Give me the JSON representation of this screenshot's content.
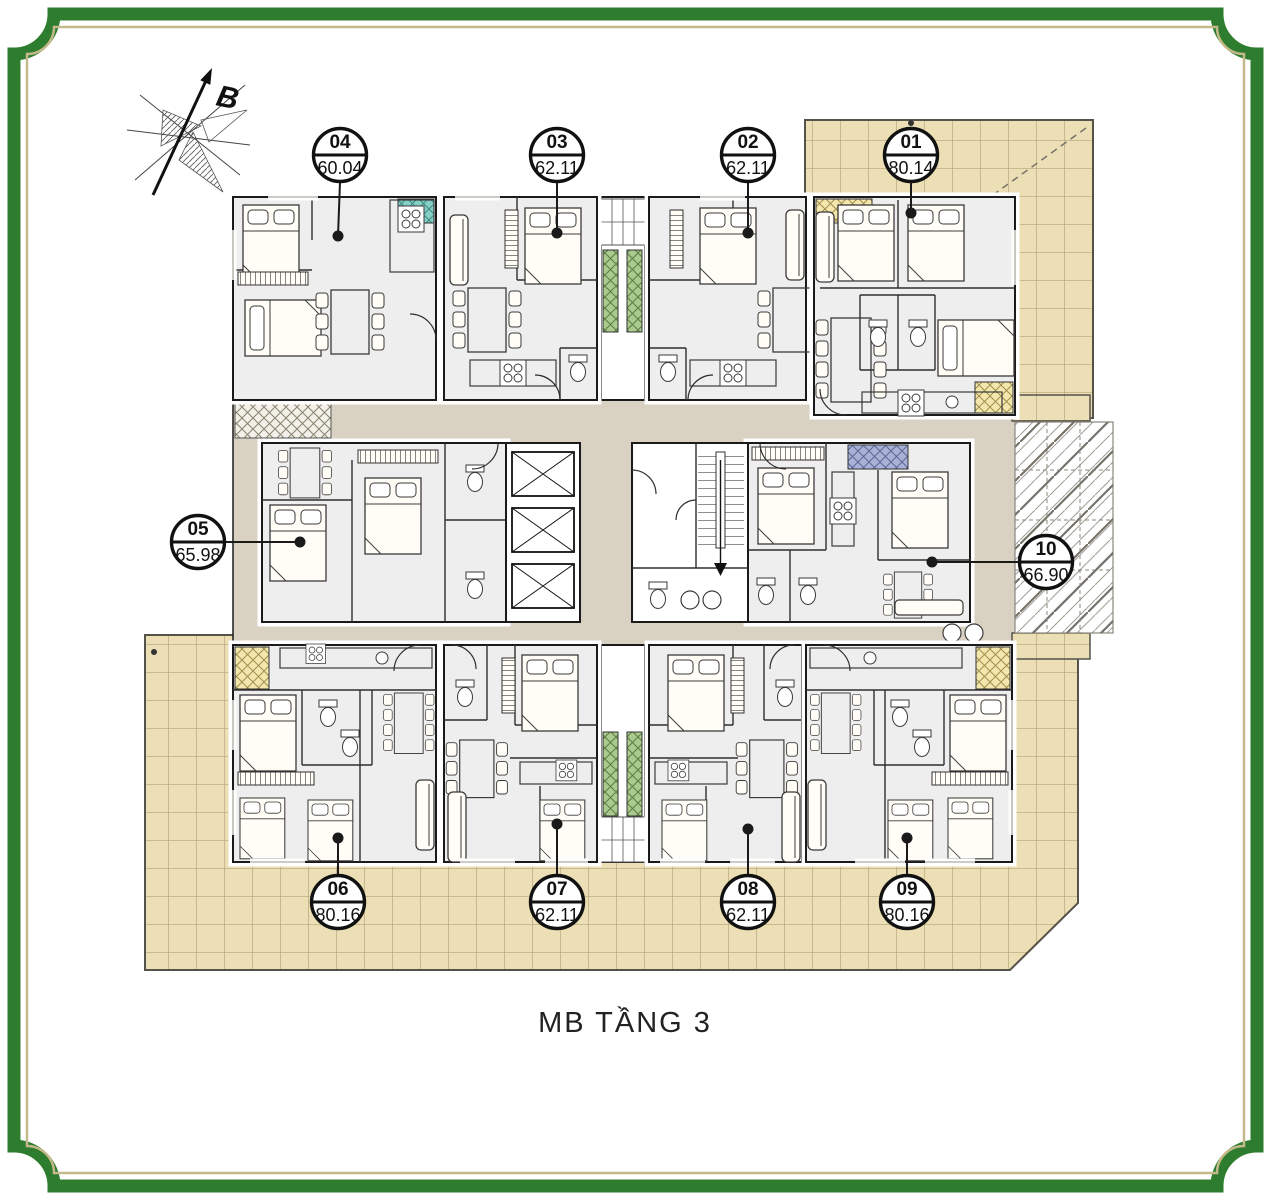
{
  "title": "MB TẦNG 3",
  "compass": {
    "label": "B"
  },
  "units": [
    {
      "id": "01",
      "area": "80.14",
      "color": "#f3e7ae"
    },
    {
      "id": "02",
      "area": "62.11",
      "color": "#a9cb8d"
    },
    {
      "id": "03",
      "area": "62.11",
      "color": "#a9cb8d"
    },
    {
      "id": "04",
      "area": "60.04",
      "color": "#85cfc7"
    },
    {
      "id": "05",
      "area": "65.98",
      "color": "#c7a5cd"
    },
    {
      "id": "06",
      "area": "80.16",
      "color": "#f3e7ae"
    },
    {
      "id": "07",
      "area": "62.11",
      "color": "#a9cb8d"
    },
    {
      "id": "08",
      "area": "62.11",
      "color": "#a9cb8d"
    },
    {
      "id": "09",
      "area": "80.16",
      "color": "#f3e7ae"
    },
    {
      "id": "10",
      "area": "66.90",
      "color": "#a9b2d6"
    }
  ],
  "palette": {
    "frame_green": "#2e7d2f",
    "frame_gold": "#c5b989",
    "corridor": "#d9d2c3",
    "terrace": "#ecdfb5",
    "terrace_grid": "#b5a478",
    "wall": "#1a1a1a"
  }
}
